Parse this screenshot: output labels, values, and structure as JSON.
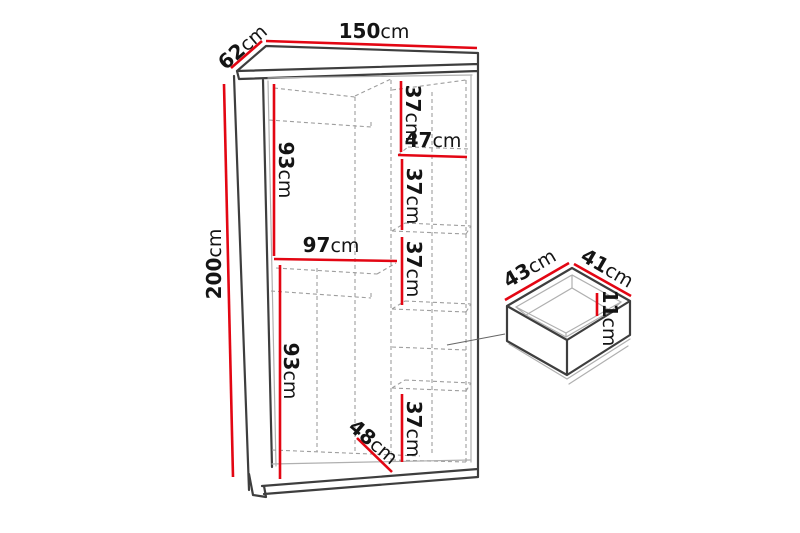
{
  "diagram": {
    "type": "furniture-dimension-diagram",
    "wardrobe": {
      "width_top": {
        "value": "150",
        "unit": "cm"
      },
      "depth_top": {
        "value": "62",
        "unit": "cm"
      },
      "height_left": {
        "value": "200",
        "unit": "cm"
      },
      "left_upper_height": {
        "value": "93",
        "unit": "cm"
      },
      "left_shelf_width": {
        "value": "97",
        "unit": "cm"
      },
      "left_lower_height": {
        "value": "93",
        "unit": "cm"
      },
      "right_shelf_width": {
        "value": "47",
        "unit": "cm"
      },
      "right_section1_height": {
        "value": "37",
        "unit": "cm"
      },
      "right_section2_height": {
        "value": "37",
        "unit": "cm"
      },
      "right_section3_height": {
        "value": "37",
        "unit": "cm"
      },
      "right_section4_height": {
        "value": "37",
        "unit": "cm"
      },
      "bottom_inner_width": {
        "value": "48",
        "unit": "cm"
      }
    },
    "drawer": {
      "width": {
        "value": "43",
        "unit": "cm"
      },
      "depth": {
        "value": "41",
        "unit": "cm"
      },
      "height": {
        "value": "11",
        "unit": "cm"
      }
    },
    "colors": {
      "dimension_line": "#e30613",
      "outline": "#3e3e3e",
      "hidden_edge": "#9e9e9e",
      "inner_edge": "#b0b0b0",
      "text": "#141414",
      "background": "#ffffff"
    }
  }
}
